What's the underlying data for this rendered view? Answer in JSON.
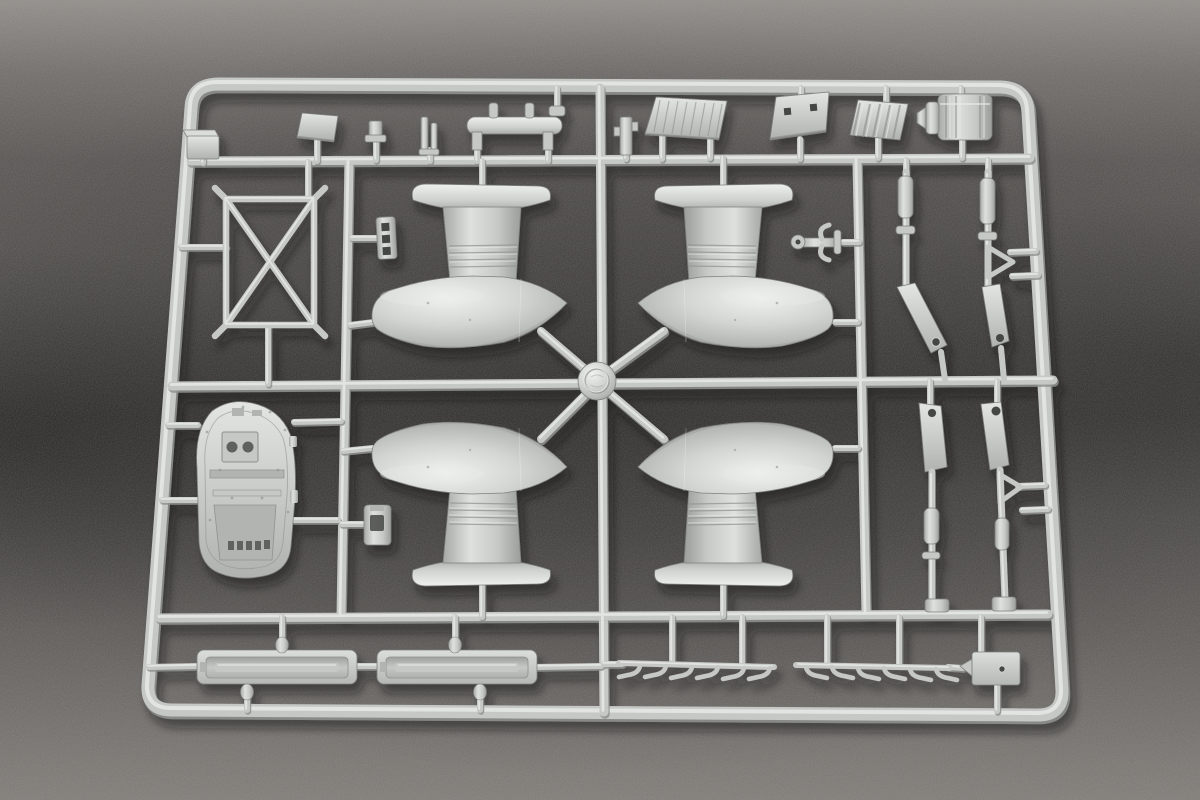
{
  "scene": {
    "caption": "Photograph of a light gray injection-molded plastic model kit sprue (parts tree) lying on dark gray felt fabric",
    "object": "model kit parts sprue",
    "background_material": "dark gray felt fabric",
    "plastic_finish": "light gray styrene"
  },
  "colors": {
    "fabric_top": "#8f8c88",
    "fabric_mid": "#4c4a47",
    "fabric_dark": "#3d3b39",
    "fabric_bottom": "#787571",
    "plastic": "#c6c8c5",
    "plastic_light": "#e9ebe8",
    "plastic_mid": "#b2b4b1",
    "plastic_shadow": "#8e908d",
    "plastic_edge": "#7e807d",
    "hole_dark": "#454745"
  },
  "medallion": {
    "shape": "circular boss at runner crossing",
    "mark": "embossed circular maker mark (illegible)"
  },
  "parts": [
    {
      "name": "sprue-frame",
      "label": "outer rectangular sprue frame with rounded corners",
      "count": 1
    },
    {
      "name": "wheel-spat-fairing",
      "label": "large teardrop wheel-spat fairing half with ribbed leg and flange",
      "count": 4
    },
    {
      "name": "strut-frame",
      "label": "X-braced rectangular strut frame",
      "count": 1
    },
    {
      "name": "cockpit-deck-panel",
      "label": "detailed rounded deck / floor panel with raised boxes and rivets",
      "count": 1
    },
    {
      "name": "landing-gear-strut",
      "label": "landing gear strut rod with flat link and bolt hole",
      "count": 4
    },
    {
      "name": "floor-rail-tray",
      "label": "long recessed rail tray",
      "count": 2
    },
    {
      "name": "exhaust-comb",
      "label": "bar with six curved exhaust stubs",
      "count": 2
    },
    {
      "name": "access-plate",
      "label": "rectangular access plate with small hole and pointed tab",
      "count": 1
    },
    {
      "name": "radiator-panel",
      "label": "corrugated radiator panel",
      "count": 1
    },
    {
      "name": "louver-panel",
      "label": "slatted louver panel",
      "count": 1
    },
    {
      "name": "hatch-plate",
      "label": "angled hatch plate with two square openings",
      "count": 1
    },
    {
      "name": "cylinder-drum",
      "label": "ribbed cylindrical drum with stepped nose",
      "count": 1
    },
    {
      "name": "small-fittings",
      "label": "assorted small brackets, pins, clips and an anchor-shaped fitting",
      "count": 12
    }
  ]
}
